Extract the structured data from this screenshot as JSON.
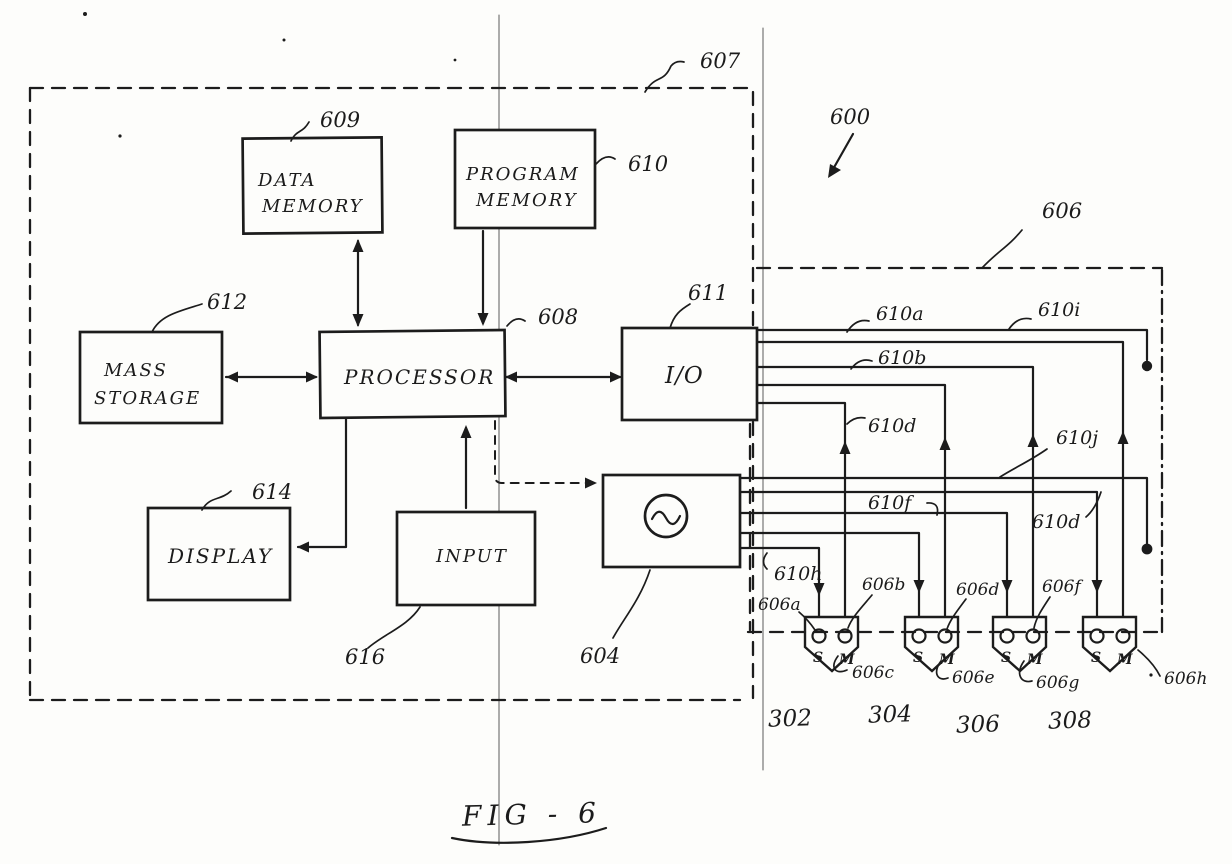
{
  "page": {
    "caption": "FIG - 6"
  },
  "refs": {
    "n600": "600",
    "n604": "604",
    "n606": "606",
    "n607": "607",
    "n608": "608",
    "n609": "609",
    "n610": "610",
    "n611": "611",
    "n612": "612",
    "n614": "614",
    "n616": "616"
  },
  "boxes": {
    "data_memory": {
      "l1": "DATA",
      "l2": "MEMORY"
    },
    "program_memory": {
      "l1": "PROGRAM",
      "l2": "MEMORY"
    },
    "mass_storage": {
      "l1": "MASS",
      "l2": "STORAGE"
    },
    "processor": {
      "l1": "PROCESSOR"
    },
    "io": {
      "l1": "I/O"
    },
    "display": {
      "l1": "DISPLAY"
    },
    "input": {
      "l1": "INPUT"
    }
  },
  "wire_labels": {
    "a": "610a",
    "i": "610i",
    "b": "610b",
    "d1": "610d",
    "j": "610j",
    "d2": "610d",
    "f": "610f",
    "h": "610h"
  },
  "contact_labels": {
    "a": "606a",
    "b": "606b",
    "c": "606c",
    "d": "606d",
    "e": "606e",
    "f": "606f",
    "g": "606g",
    "h": "606h"
  },
  "port_labels": {
    "p302": "302",
    "p304": "304",
    "p306": "306",
    "p308": "308"
  },
  "selector": {
    "s": "S",
    "m": "M"
  }
}
